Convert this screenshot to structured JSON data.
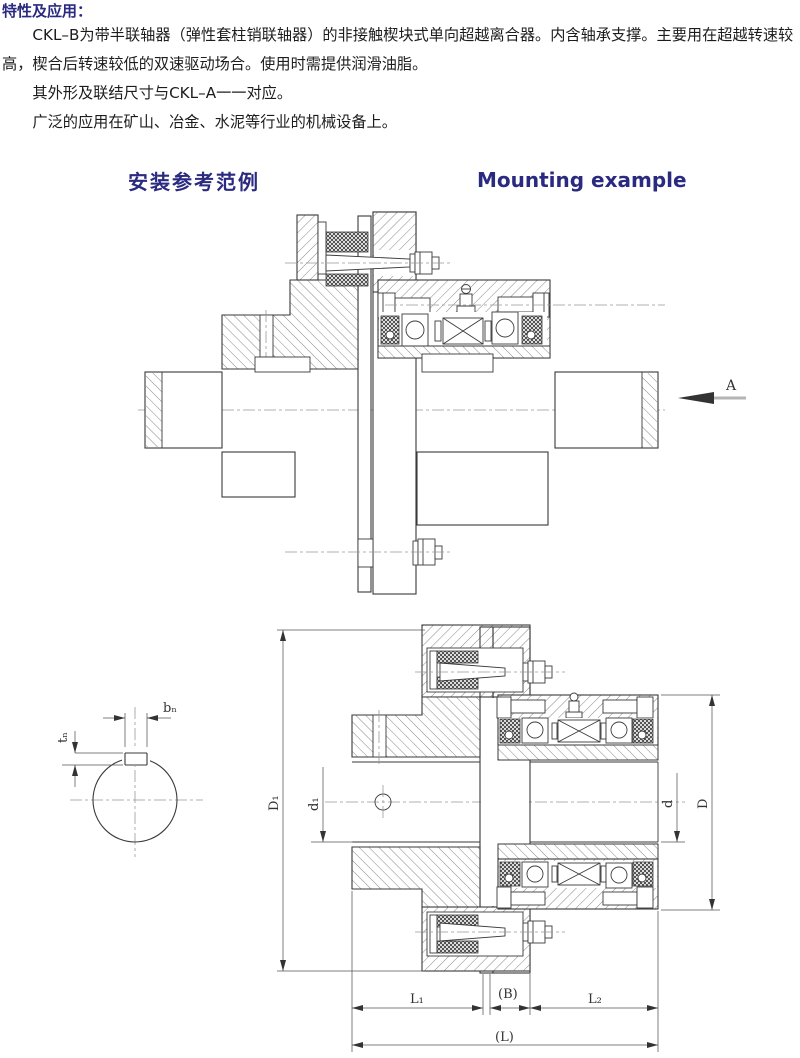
{
  "document": {
    "section_heading": "特性及应用：",
    "paragraphs": [
      "CKL–B为带半联轴器（弹性套柱销联轴器）的非接触楔块式单向超越离合器。内含轴承支撑。主要用在超越转速较高，楔合后转速较低的双速驱动场合。使用时需提供润滑油脂。",
      "其外形及联结尺寸与CKL–A一一对应。",
      "广泛的应用在矿山、冶金、水泥等行业的机械设备上。"
    ],
    "drawing_heading_cn": "安装参考范例",
    "drawing_heading_en": "Mounting example"
  },
  "labels": {
    "view_arrow": "A",
    "D1": "D₁",
    "d1": "d₁",
    "d": "d",
    "D": "D",
    "L1": "L₁",
    "B": "(B)",
    "L2": "L₂",
    "L": "(L)",
    "bn": "bₙ",
    "tn": "tₙ"
  },
  "colors": {
    "heading": "#2a2a80",
    "body_text": "#1c1c1c",
    "drawing_line": "#3a3a3a",
    "centerline": "#999999",
    "background": "#ffffff"
  }
}
